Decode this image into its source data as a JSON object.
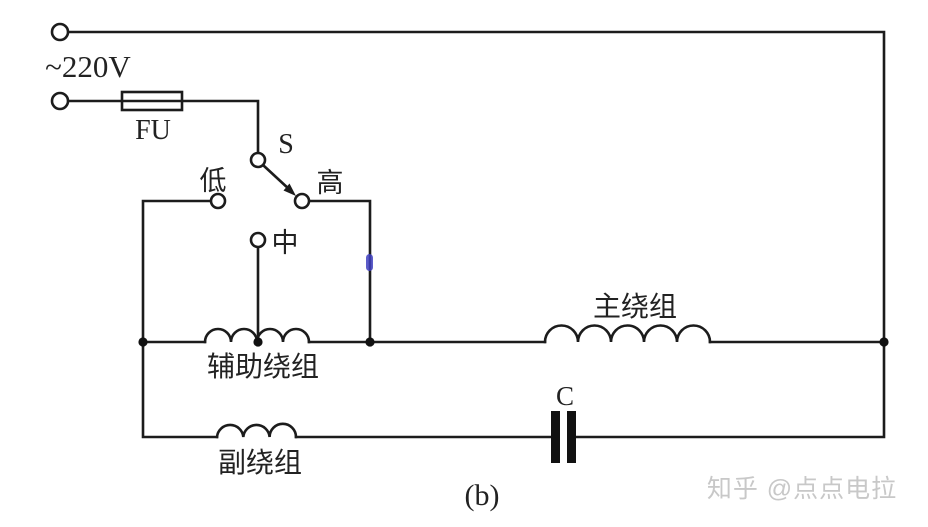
{
  "diagram": {
    "caption": "(b)",
    "watermark": "知乎 @点点电拉",
    "power_supply": {
      "label": "~220V"
    },
    "fuse": {
      "label": "FU"
    },
    "switch": {
      "label": "S",
      "positions": {
        "low": "低",
        "mid": "中",
        "high": "高"
      }
    },
    "windings": {
      "main": "主绕组",
      "auxiliary": "辅助绕组",
      "secondary": "副绕组"
    },
    "capacitor": {
      "label": "C"
    },
    "colors": {
      "line": "#1c1c1c",
      "background": "#ffffff",
      "blue_mark": "#4040c0",
      "watermark": "#c8c8c8"
    }
  }
}
